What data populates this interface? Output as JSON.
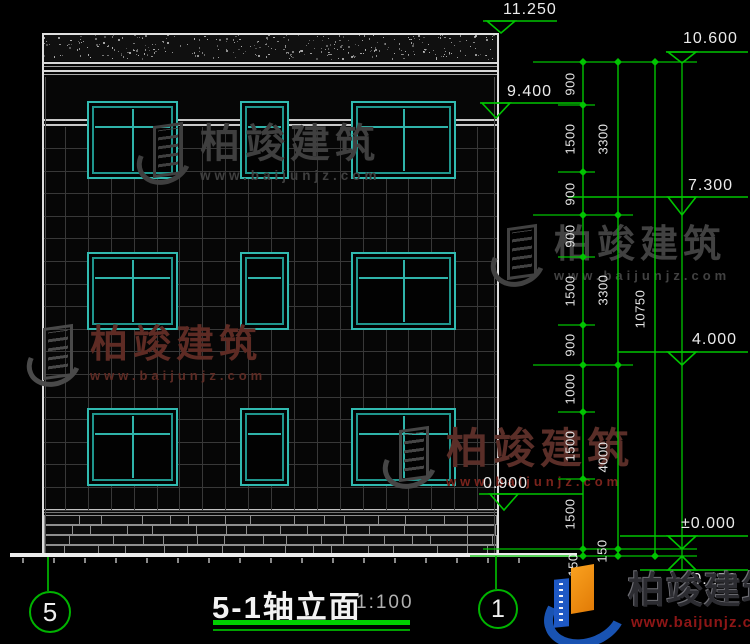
{
  "drawing": {
    "title": "5-1轴立面",
    "scale": "1:100",
    "axis_left": "5",
    "axis_right": "1",
    "levels": [
      "11.250",
      "10.600",
      "9.400",
      "7.300",
      "4.000",
      "0.900",
      "±0.000",
      "-0.150"
    ],
    "dim_chain_inner": [
      "900",
      "1500",
      "900",
      "900",
      "1500",
      "900",
      "1000",
      "1500",
      "1500",
      "150"
    ],
    "dim_chain_middle": [
      "3300",
      "3300",
      "4000",
      "150"
    ],
    "dim_chain_outer": [
      "10750"
    ]
  },
  "watermark": {
    "brand": "柏竣建筑",
    "url": "www.baijunjz.com"
  },
  "colors": {
    "line_green": "#00c400",
    "window_teal": "#2fb3aa",
    "dim_text": "#e6e6e6",
    "watermark_gray": "#3f3f3f",
    "watermark_red": "#5e2b24",
    "logo_blue": "#1953b2",
    "logo_orange": "#ef8a12"
  }
}
